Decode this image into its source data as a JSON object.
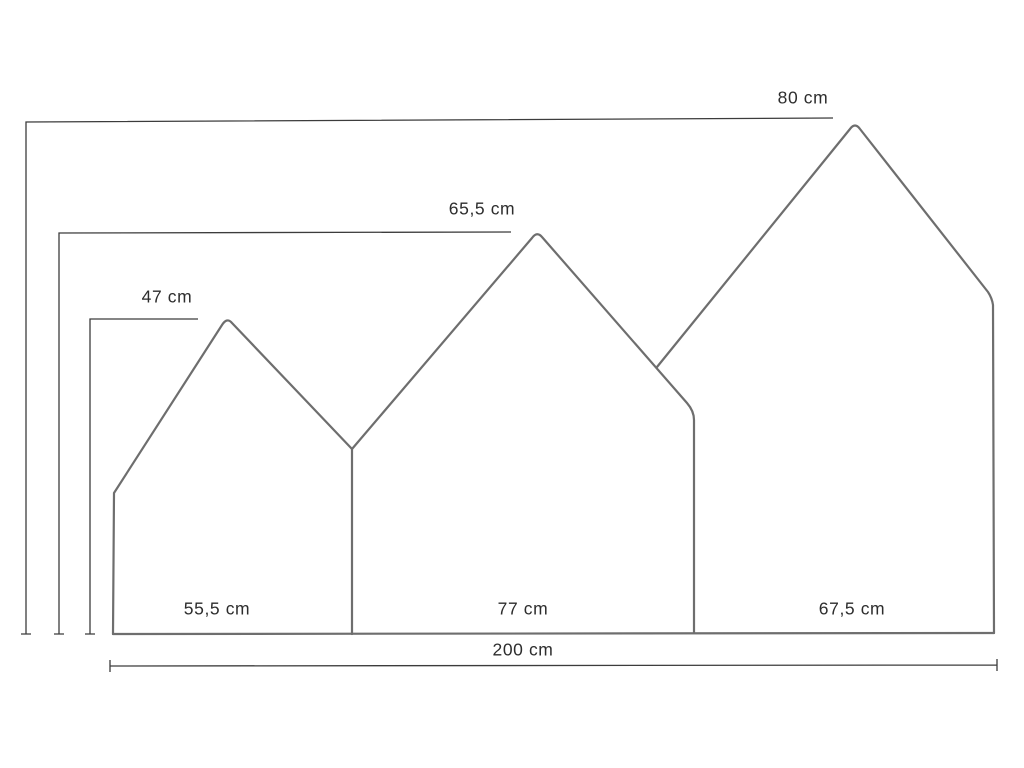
{
  "diagram": {
    "description": "Dimension drawing of a three-panel house-shaped headboard",
    "labels": {
      "height_back": "80 cm",
      "height_middle": "65,5 cm",
      "height_front": "47 cm",
      "width_left": "55,5 cm",
      "width_middle": "77 cm",
      "width_right": "67,5 cm",
      "width_total": "200 cm"
    },
    "panels": [
      {
        "position": "left",
        "width_cm": 55.5,
        "height_cm": 47
      },
      {
        "position": "middle",
        "width_cm": 77,
        "height_cm": 65.5
      },
      {
        "position": "right",
        "width_cm": 67.5,
        "height_cm": 80
      }
    ],
    "total_width_cm": 200
  },
  "colors": {
    "background": "#ffffff",
    "outline": "#6e6e6e",
    "dimension": "#3c3c3c",
    "text": "#2d2d2d"
  }
}
